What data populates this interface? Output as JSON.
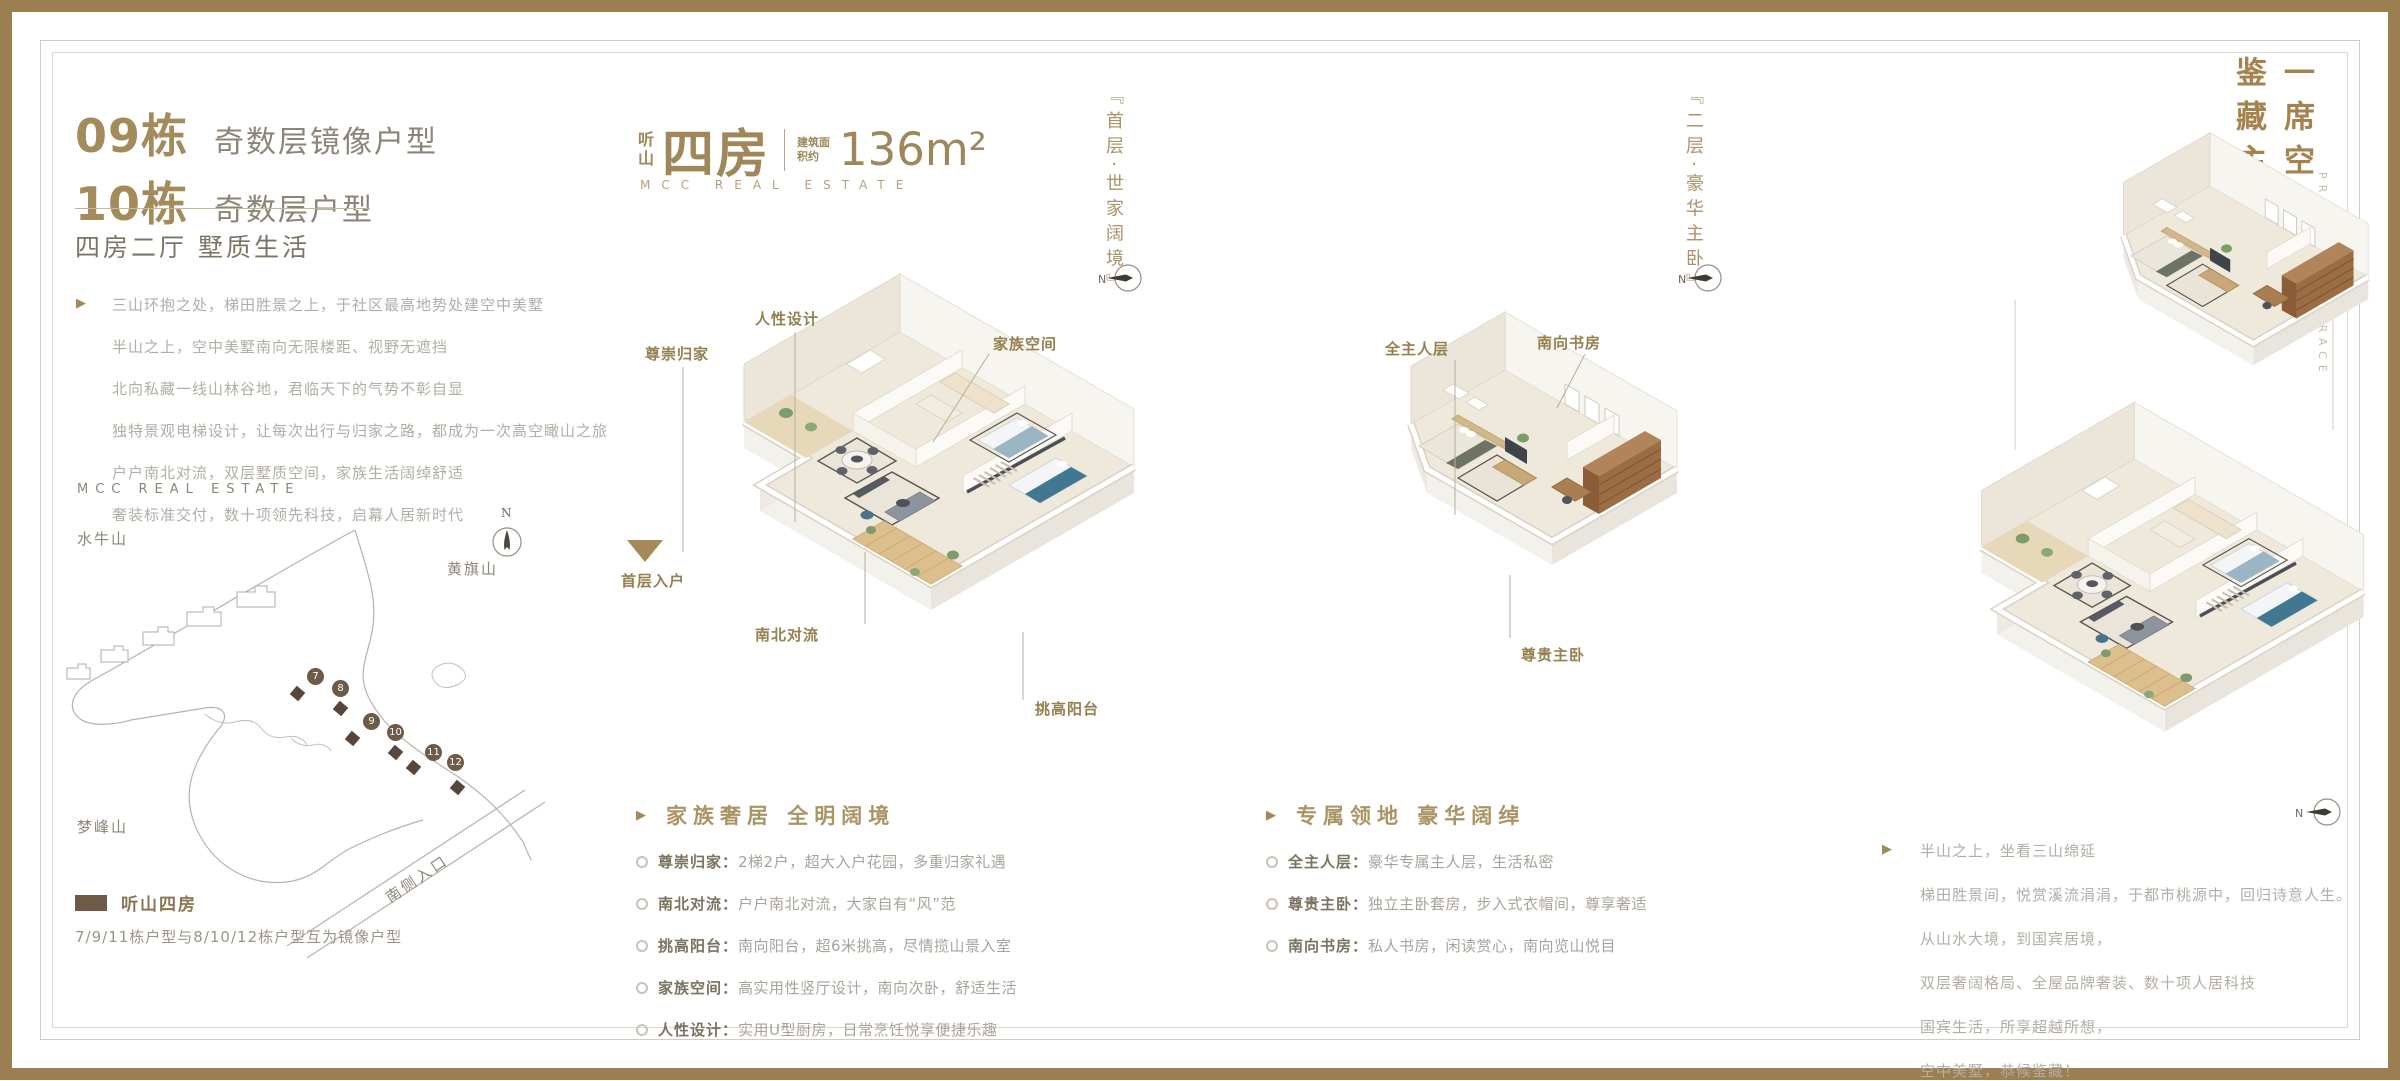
{
  "left": {
    "block1_num": "09栋",
    "block1_text": "奇数层镜像户型",
    "block2_num": "10栋",
    "block2_text": "奇数层户型",
    "subtitle": "四房二厅  墅质生活",
    "intro": [
      "三山环抱之处，梯田胜景之上，于社区最高地势处建空中美墅",
      "半山之上，空中美墅南向无限楼距、视野无遮挡",
      "北向私藏一线山林谷地，君临天下的气势不彰自显",
      "独特景观电梯设计，让每次出行与归家之路，都成为一次高空瞰山之旅",
      "户户南北对流，双层墅质空间，家族生活阔绰舒适",
      "奢装标准交付，数十项领先科技，启幕人居新时代"
    ],
    "brand": "MCC REAL ESTATE",
    "map": {
      "compass": "N",
      "mountain_nw": "水牛山",
      "mountain_e": "黄旗山",
      "mountain_sw": "梦峰山",
      "entrance": "南侧入口",
      "buildings": [
        "7",
        "8",
        "9",
        "10",
        "11",
        "12"
      ],
      "legend": "听山四房",
      "note": "7/9/11栋户型与8/10/12栋户型互为镜像户型"
    }
  },
  "title": {
    "prefix": "听山",
    "main": "四房",
    "badge": "建筑面积约",
    "area": "136m²",
    "brand": "MCC REAL ESTATE"
  },
  "floor1": {
    "tab": "『首层·世家阔境』",
    "compass": "N",
    "labels": {
      "renxing": "人性设计",
      "zuncong": "尊崇归家",
      "jiazu": "家族空间",
      "nanbei": "南北对流",
      "tiaogao": "挑高阳台",
      "entry": "首层入户"
    },
    "list_heading": "家族奢居 全明阔境",
    "arrow": "▶",
    "items": [
      {
        "label": "尊崇归家：",
        "text": "2梯2户，超大入户花园，多重归家礼遇"
      },
      {
        "label": "南北对流：",
        "text": "户户南北对流，大家自有“风”范"
      },
      {
        "label": "挑高阳台：",
        "text": "南向阳台，超6米挑高，尽情揽山景入室"
      },
      {
        "label": "家族空间：",
        "text": "高实用性竖厅设计，南向次卧，舒适生活"
      },
      {
        "label": "人性设计：",
        "text": "实用U型厨房，日常烹饪悦享便捷乐趣"
      }
    ]
  },
  "floor2": {
    "tab": "『二层·豪华主卧』",
    "compass": "N",
    "labels": {
      "quanzhu": "全主人层",
      "nanxiang": "南向书房",
      "zungui": "尊贵主卧"
    },
    "list_heading": "专属领地 豪华阔绰",
    "arrow": "▶",
    "items": [
      {
        "label": "全主人层：",
        "text": "豪华专属主人层，生活私密"
      },
      {
        "label": "尊贵主卧：",
        "text": "独立主卧套房，步入式衣帽间，尊享奢适"
      },
      {
        "label": "南向书房：",
        "text": "私人书房，闲读赏心，南向览山悦目"
      }
    ]
  },
  "right": {
    "vtitle_line1": "一席空中美墅",
    "vtitle_line2": "鉴藏主城墅居",
    "ven": "PRECIOUS TERRACE",
    "compass": "N",
    "arrow": "▶",
    "outro": [
      "半山之上，坐看三山绵延",
      "梯田胜景间，悦赏溪流涓涓，于都市桃源中，回归诗意人生。",
      "从山水大境，到国宾居境，",
      "双层奢阔格局、全屋品牌奢装、数十项人居科技",
      "国宾生活，所享超越所想，",
      "空中美墅，恭候鉴藏！"
    ]
  }
}
